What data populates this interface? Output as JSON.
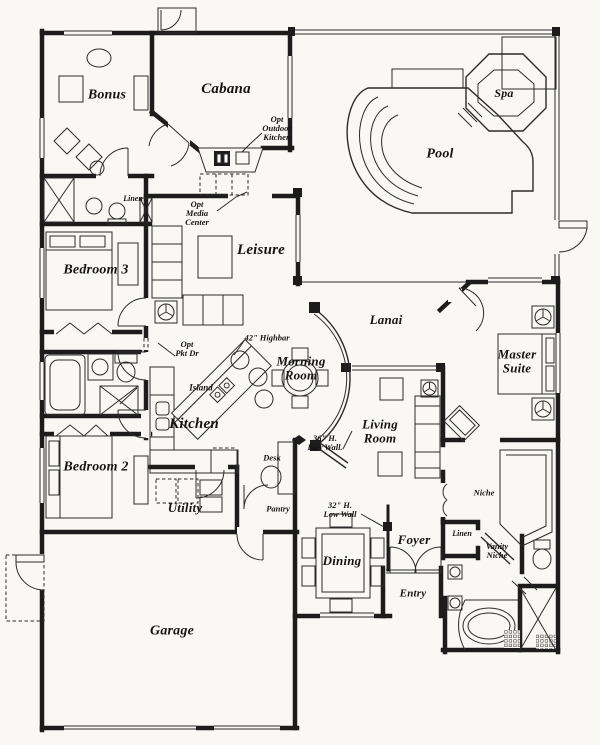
{
  "plan": {
    "title": "Single-story house floor plan with pool",
    "colors": {
      "paper": "#f9f8f4",
      "ink": "#1c1c1c"
    },
    "labels": [
      {
        "name": "bonus-room",
        "text": "Bonus",
        "x": 107,
        "y": 96,
        "fs": 14,
        "cls": "room"
      },
      {
        "name": "cabana",
        "text": "Cabana",
        "x": 226,
        "y": 90,
        "fs": 15,
        "cls": "room"
      },
      {
        "name": "spa",
        "text": "Spa",
        "x": 504,
        "y": 93,
        "fs": 12,
        "cls": "room"
      },
      {
        "name": "pool",
        "text": "Pool",
        "x": 440,
        "y": 155,
        "fs": 14,
        "cls": "room"
      },
      {
        "name": "leisure",
        "text": "Leisure",
        "x": 261,
        "y": 251,
        "fs": 15,
        "cls": "room"
      },
      {
        "name": "bedroom-3",
        "text": "Bedroom 3",
        "x": 96,
        "y": 271,
        "fs": 14,
        "cls": "room"
      },
      {
        "name": "lanai",
        "text": "Lanai",
        "x": 386,
        "y": 320,
        "fs": 13,
        "cls": "room"
      },
      {
        "name": "master-suite",
        "text": "Master\nSuite",
        "x": 517,
        "y": 361,
        "fs": 13,
        "cls": "room"
      },
      {
        "name": "morning-room",
        "text": "Morning\nRoom",
        "x": 301,
        "y": 368,
        "fs": 13,
        "cls": "room"
      },
      {
        "name": "kitchen",
        "text": "Kitchen",
        "x": 194,
        "y": 425,
        "fs": 15,
        "cls": "room"
      },
      {
        "name": "living-room",
        "text": "Living\nRoom",
        "x": 380,
        "y": 431,
        "fs": 13,
        "cls": "room"
      },
      {
        "name": "bedroom-2",
        "text": "Bedroom 2",
        "x": 96,
        "y": 468,
        "fs": 14,
        "cls": "room"
      },
      {
        "name": "utility",
        "text": "Utility",
        "x": 185,
        "y": 508,
        "fs": 13,
        "cls": "room"
      },
      {
        "name": "foyer",
        "text": "Foyer",
        "x": 414,
        "y": 540,
        "fs": 13,
        "cls": "room"
      },
      {
        "name": "dining",
        "text": "Dining",
        "x": 342,
        "y": 561,
        "fs": 13,
        "cls": "room"
      },
      {
        "name": "entry",
        "text": "Entry",
        "x": 413,
        "y": 594,
        "fs": 11,
        "cls": "room"
      },
      {
        "name": "garage",
        "text": "Garage",
        "x": 172,
        "y": 632,
        "fs": 14,
        "cls": "room"
      },
      {
        "name": "opt-outdoor-kitchen",
        "text": "Opt\nOutdoor\nKitchen",
        "x": 277,
        "y": 128,
        "fs": 8.5,
        "cls": "ann"
      },
      {
        "name": "linen-top",
        "text": "Linen",
        "x": 133,
        "y": 199,
        "fs": 8,
        "cls": "ann"
      },
      {
        "name": "opt-media-center",
        "text": "Opt\nMedia\nCenter",
        "x": 197,
        "y": 213,
        "fs": 8.5,
        "cls": "ann"
      },
      {
        "name": "opt-pkt-dr",
        "text": "Opt\nPkt Dr",
        "x": 187,
        "y": 349,
        "fs": 8.5,
        "cls": "ann"
      },
      {
        "name": "highbar-42",
        "text": "42\" Highbar",
        "x": 267,
        "y": 338,
        "fs": 8.5,
        "cls": "ann"
      },
      {
        "name": "island",
        "text": "Island",
        "x": 201,
        "y": 388,
        "fs": 9,
        "cls": "ann"
      },
      {
        "name": "desk",
        "text": "Desk",
        "x": 272,
        "y": 458,
        "fs": 8.5,
        "cls": "ann"
      },
      {
        "name": "pantry",
        "text": "Pantry",
        "x": 278,
        "y": 509,
        "fs": 8.5,
        "cls": "ann"
      },
      {
        "name": "low-wall-36",
        "text": "36\" H.\nLow Wall.",
        "x": 325,
        "y": 443,
        "fs": 8.5,
        "cls": "ann"
      },
      {
        "name": "low-wall-32",
        "text": "32\" H.\nLow Wall",
        "x": 340,
        "y": 510,
        "fs": 8.5,
        "cls": "ann"
      },
      {
        "name": "niche",
        "text": "Niche",
        "x": 484,
        "y": 493,
        "fs": 8.5,
        "cls": "ann"
      },
      {
        "name": "linen-bottom",
        "text": "Linen",
        "x": 462,
        "y": 534,
        "fs": 8,
        "cls": "ann"
      },
      {
        "name": "vanity-niche",
        "text": "Vanity\nNiche",
        "x": 497,
        "y": 551,
        "fs": 8.5,
        "cls": "ann"
      }
    ]
  }
}
